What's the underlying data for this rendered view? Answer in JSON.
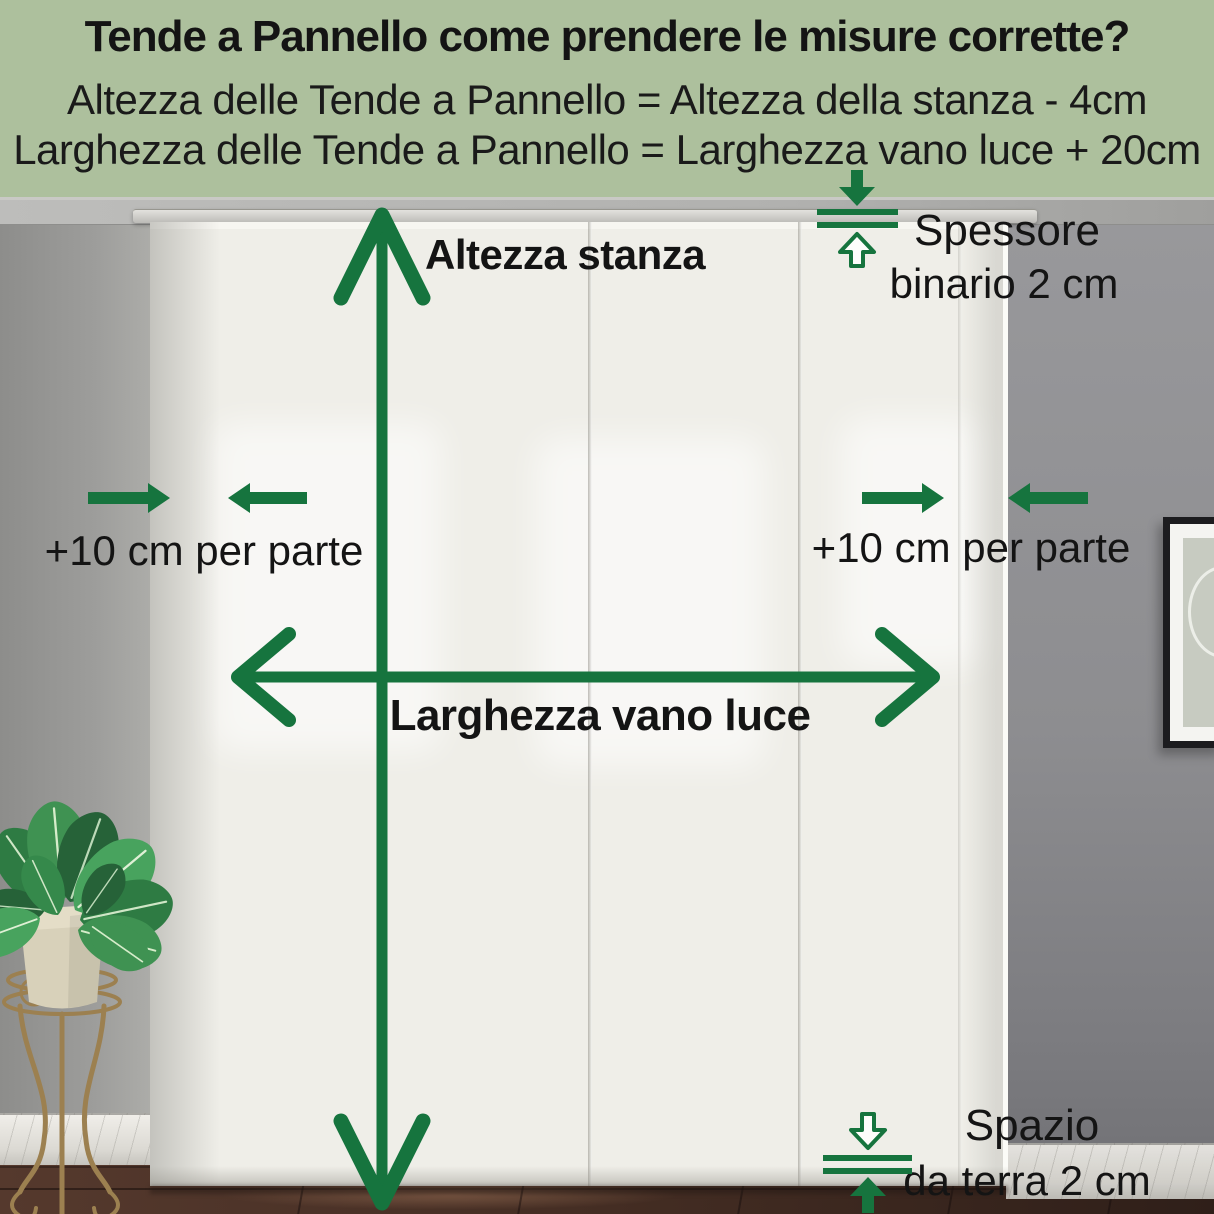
{
  "header": {
    "title": "Tende a Pannello come prendere le misure corrette?",
    "formula_height": "Altezza delle Tende a Pannello = Altezza della stanza - 4cm",
    "formula_width": "Larghezza delle Tende a Pannello = Larghezza vano luce + 20cm"
  },
  "annotations": {
    "room_height": "Altezza stanza",
    "window_width": "Larghezza vano luce",
    "side_margin_left": "+10 cm per parte",
    "side_margin_right": "+10 cm per parte",
    "rail_thickness_line1": "Spessore",
    "rail_thickness_line2": "binario 2 cm",
    "floor_gap_line1": "Spazio",
    "floor_gap_line2": "da terra 2 cm"
  },
  "colors": {
    "accent_green": "#16743e",
    "header_background": "#adc09d",
    "text": "#141414"
  },
  "icons": {
    "room-height-arrow-icon": "vertical double-headed line arrow",
    "window-width-arrow-icon": "horizontal double-headed line arrow",
    "margin-arrows-left-icon": "two solid arrows pointing toward the panel edge",
    "margin-arrows-right-icon": "two solid arrows pointing toward the panel edge",
    "rail-thickness-marker-icon": "solid down arrow, two gap lines, outlined up arrow",
    "floor-gap-marker-icon": "outlined down arrow, two gap lines, solid up arrow"
  },
  "scene": {
    "alt": "white panel curtains hanging from a rail in a grey room, potted plant on a metal stand at left, framed picture at right, dark wooden floor"
  }
}
